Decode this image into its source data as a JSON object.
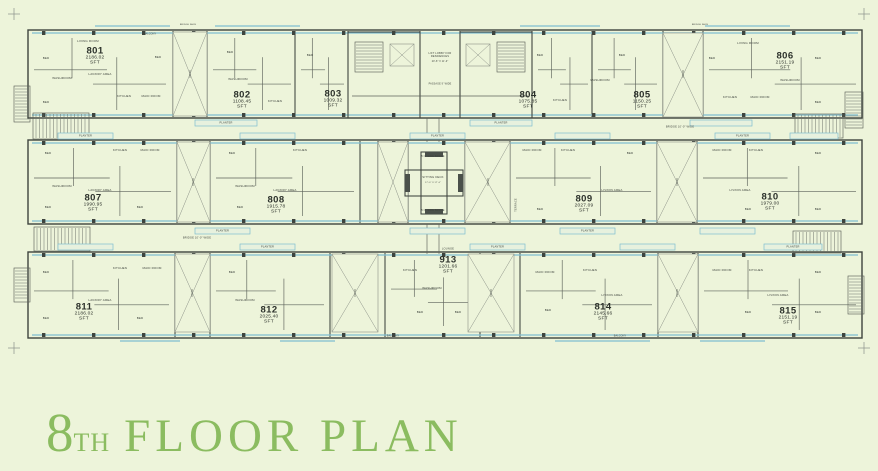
{
  "title": {
    "floor_number": "8",
    "floor_ordinal": "TH",
    "label": "FLOOR PLAN"
  },
  "units": [
    {
      "number": "801",
      "area_sft": "2186.02"
    },
    {
      "number": "802",
      "area_sft": "1108.45"
    },
    {
      "number": "803",
      "area_sft": "1009.32"
    },
    {
      "number": "804",
      "area_sft": "1075.85"
    },
    {
      "number": "805",
      "area_sft": "1150.25"
    },
    {
      "number": "806",
      "area_sft": "2151.19"
    },
    {
      "number": "807",
      "area_sft": "1990.95"
    },
    {
      "number": "808",
      "area_sft": "1915.78"
    },
    {
      "number": "809",
      "area_sft": "2027.09"
    },
    {
      "number": "810",
      "area_sft": "1979.00"
    },
    {
      "number": "811",
      "area_sft": "2186.02"
    },
    {
      "number": "812",
      "area_sft": "2025.40"
    },
    {
      "number": "913",
      "area_sft": "1201.66"
    },
    {
      "number": "814",
      "area_sft": "2145.66"
    },
    {
      "number": "815",
      "area_sft": "2151.19"
    }
  ],
  "annotations": {
    "sft": "SFT",
    "void": "VOID",
    "planter": "PLANTER",
    "sitting_deck": "SITTING DECK",
    "deck_dim": "17'-0\" X 17'-0\"",
    "bridge_5": "5'-0\" WIDE BRIDGE",
    "bridge_10": "BRIDGE 10'-0\" WIDE",
    "lift_lobby": "LIFT LOBBY FOR RESIDENCES",
    "lobby_dim": "20'-8\" X 11'-0\"",
    "passage": "PASSAGE 9' WIDE",
    "lounge": "LOUNGE",
    "bridge_face": "BRIDGE FACE",
    "balcony": "BALCONY",
    "living_room": "LIVING ROOM",
    "bed": "BED",
    "kitchen": "KITCHEN",
    "maid_room": "MAID ROOM",
    "washroom": "WASHROOM",
    "lav_dry": "LAV/DRY AREA",
    "liv_din": "LIV/DIN AREA",
    "terrace": "TERRACE",
    "stair": "STAIR"
  },
  "colors": {
    "background": "#edf4da",
    "wall": "#3e443e",
    "glazing": "#7fbed1",
    "title_green": "#8bbc60",
    "text_dark": "#2c312b",
    "void_line": "#8b9187"
  }
}
